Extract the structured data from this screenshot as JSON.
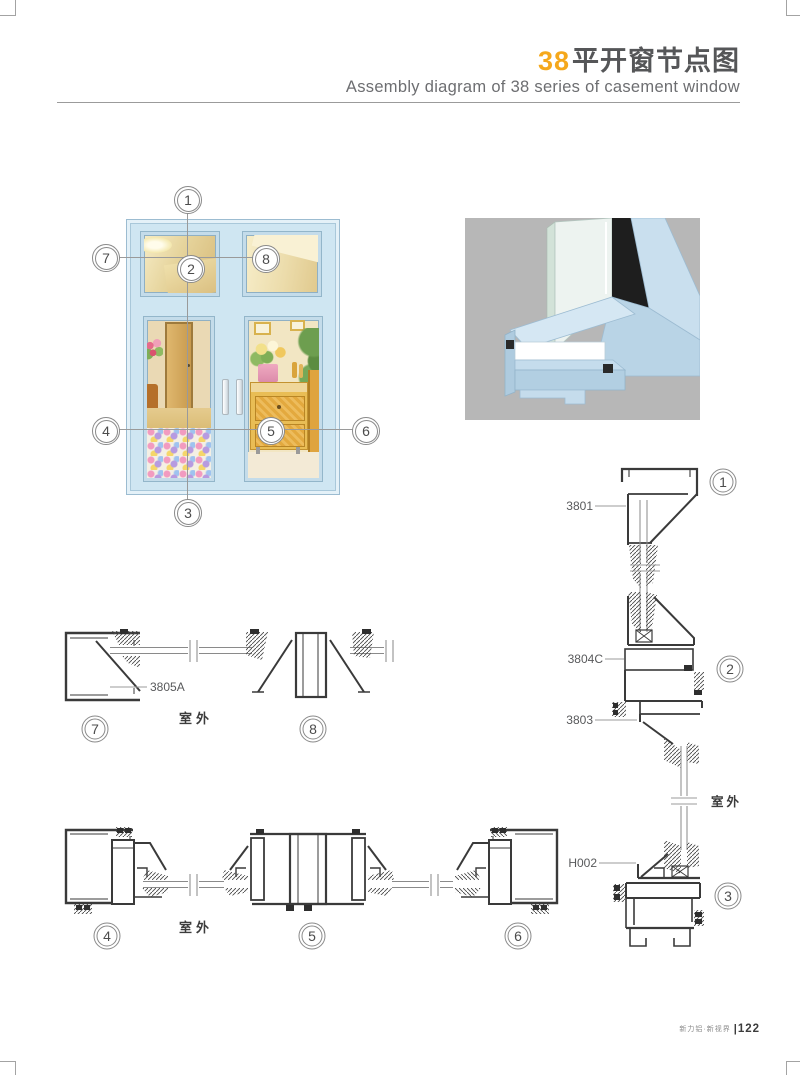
{
  "header": {
    "series_number": "38",
    "title_zh": "平开窗节点图",
    "subtitle_en": "Assembly diagram of 38 series of casement window"
  },
  "callouts": {
    "c1": "1",
    "c2": "2",
    "c3": "3",
    "c4": "4",
    "c5": "5",
    "c6": "6",
    "c7": "7",
    "c8": "8"
  },
  "section_labels": {
    "p3801": "3801",
    "p3804c": "3804C",
    "p3803": "3803",
    "ph002": "H002",
    "p3805a": "3805A"
  },
  "labels": {
    "outdoor": "室外"
  },
  "footer": {
    "slogan": "新力铝·新视界",
    "page_number": "122"
  },
  "colors": {
    "accent_orange": "#F5A81C",
    "title_gray": "#555658",
    "frame_blue": "#CFE6F2",
    "render_background_gray": "#B7B7B7",
    "drawing_line": "#3A3A3A",
    "callout_ring": "#8A8A8A"
  }
}
